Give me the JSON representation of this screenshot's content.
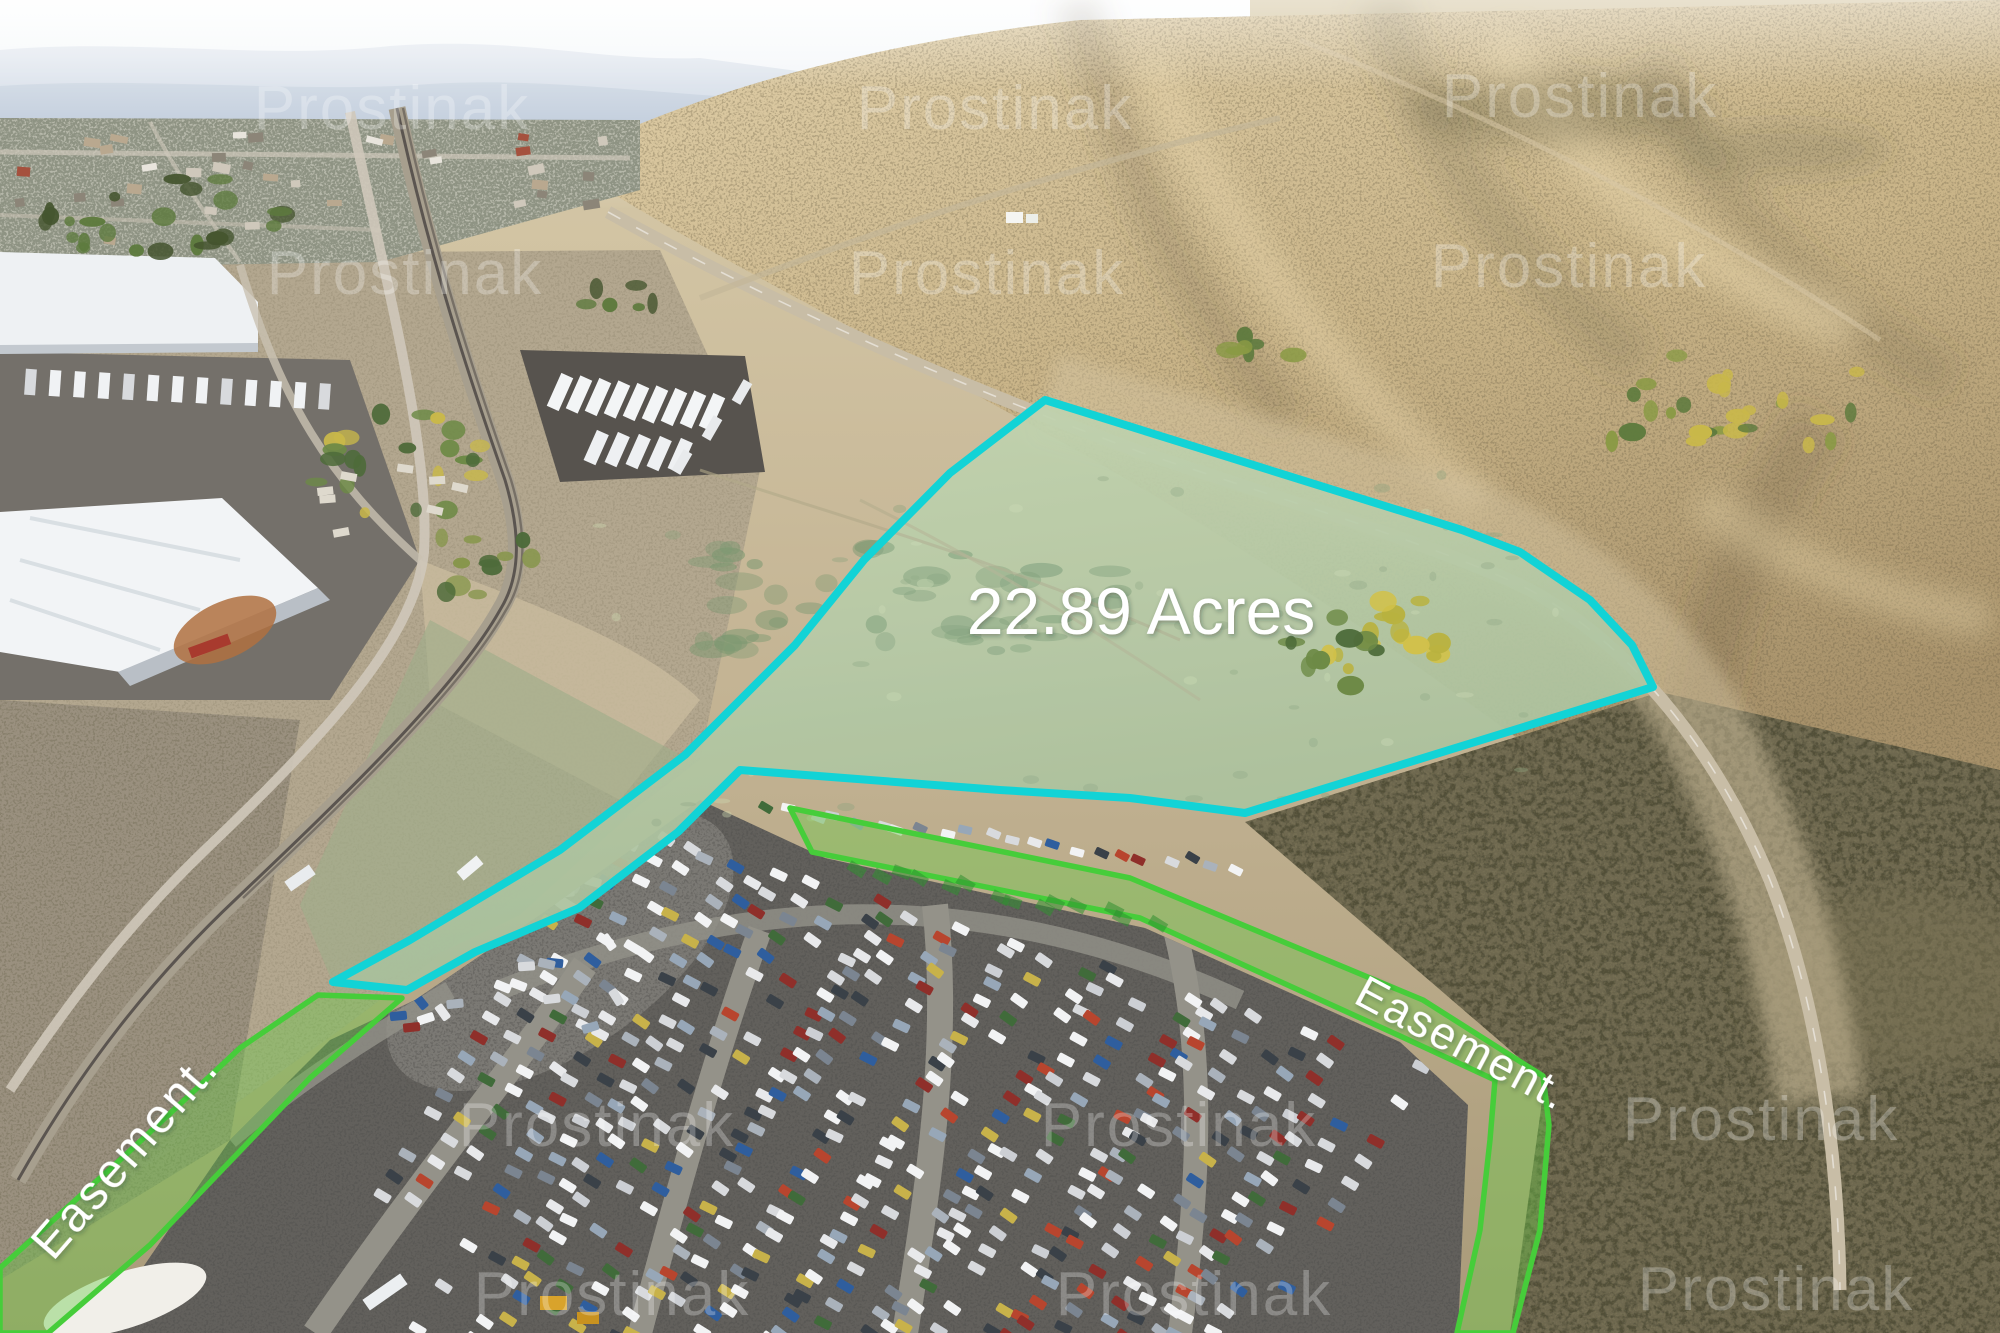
{
  "photo": {
    "width": 2000,
    "height": 1333,
    "description": "Aerial drone photo of a high-desert land parcel beside a railroad, warehouses and a large auto storage yard, with real-estate annotation overlays"
  },
  "palette": {
    "cyan": "#12d3d6",
    "cyan_fill": "rgba(180,248,240,0.14)",
    "green": "#46cd3a",
    "green_fill": "rgba(104,203,70,0.40)",
    "white": "#ffffff",
    "sand": "#cdbd9b",
    "hill_light": "#dcc9a4",
    "hill_dark": "#ad9668",
    "sage_parcel": "#b9c6a0",
    "dark_lot": "#615f5b",
    "scrub_dark": "#4a4a33"
  },
  "annotations": {
    "area_label": {
      "text": "22.89 Acres",
      "x": 1141,
      "y": 634,
      "font_size": 66,
      "color": "#ffffff"
    },
    "parcel_outline": {
      "color": "#12d3d6",
      "stroke_width": 8,
      "points": "1045,400 1462,530 1520,552 1590,600 1632,645 1653,687 1245,813 1130,798 1000,790 740,770 678,832 579,908 475,952 407,990 333,982 410,940 560,850 685,755 795,645 864,560 950,473"
    },
    "easements": [
      {
        "id": "left",
        "label": "Easement.",
        "label_x": 53,
        "label_y": 1262,
        "rotation": -49,
        "font_size": 48,
        "letter_spacing": 3,
        "path": "M318,995 L240,1048 L120,1160 L0,1268 L0,1333 L48,1333 L150,1245 L310,1078 L402,998 Z"
      },
      {
        "id": "right",
        "label": "Easement.",
        "label_x": 1352,
        "label_y": 1002,
        "rotation": 28,
        "font_size": 45,
        "letter_spacing": 2,
        "path": "M790,808 L1130,878 L1423,1000 L1543,1076 L1549,1125 L1540,1230 L1513,1333 L1457,1333 L1480,1230 L1490,1140 L1495,1080 L1400,1036 L1140,918 L812,852 Z"
      }
    ]
  },
  "watermark": {
    "text": "Prostinak",
    "color": "#ffffff",
    "opacity": 0.27,
    "font_size": 62,
    "instances": [
      [
        392,
        107
      ],
      [
        995,
        107
      ],
      [
        1580,
        95
      ],
      [
        405,
        272
      ],
      [
        987,
        272
      ],
      [
        1569,
        265
      ],
      [
        597,
        1124
      ],
      [
        1179,
        1124
      ],
      [
        1761,
        1118
      ],
      [
        612,
        1293
      ],
      [
        1194,
        1293
      ],
      [
        1776,
        1288
      ]
    ]
  }
}
